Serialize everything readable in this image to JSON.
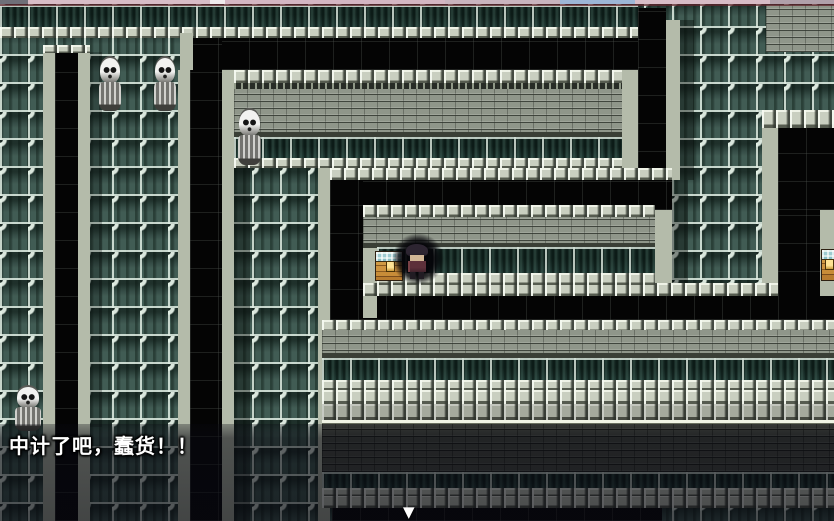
{
  "scene": {
    "type": "rpg-dungeon-maze",
    "description": "Tiled dungeon maze with black corridors, stone brick walls, green lattice wall tiles, skull statues, treasure chests and a player character"
  },
  "dialogue": {
    "text": "中计了吧，蠢货！！",
    "continue_indicator": "▼"
  },
  "entities": {
    "skull_statues": {
      "count": 4,
      "label": "skull-statue"
    },
    "treasure_chests": {
      "count": 2,
      "label": "treasure-chest",
      "note": "one beside the hero, one clipped at right edge"
    },
    "player_character": {
      "label": "hero",
      "effect": "surrounded by dark circle"
    }
  },
  "palette": {
    "lattice_panel": "#415c54",
    "lattice_frame": "#e4f0e6",
    "corridor_black": "#040404",
    "brick_wall": "#8f968a",
    "brick_wall_dark": "#474b43",
    "cap_stone": "#c9cfc0",
    "chest_gold": "#cf9440",
    "chest_lid_stripe": "#9ecbd0",
    "overlay": "rgba(8,8,16,0.6)",
    "topbar_pink": "#d8bcc6",
    "topbar_blue": "#9db6d6",
    "topbar_red_line": "#60262e",
    "text_color": "#ffffff"
  }
}
